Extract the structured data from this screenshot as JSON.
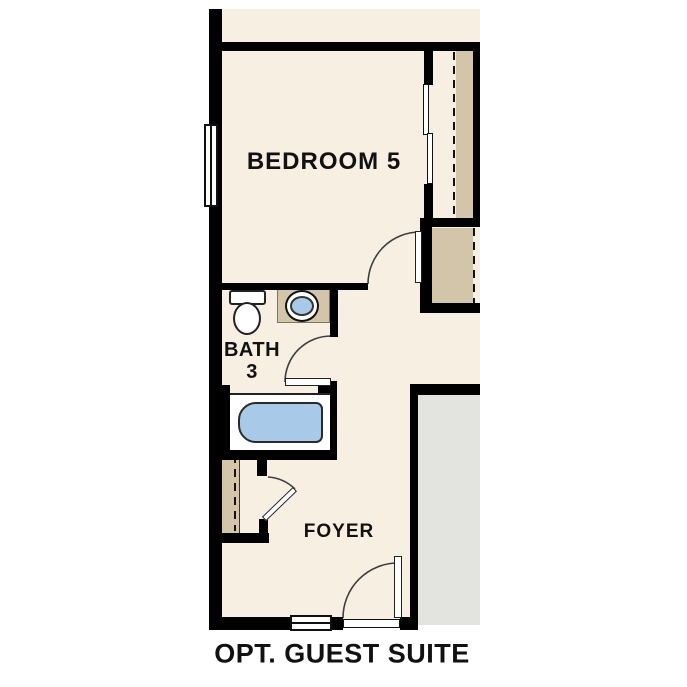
{
  "title": "OPT. GUEST SUITE",
  "rooms": {
    "bedroom": {
      "label": "BEDROOM 5"
    },
    "bath": {
      "label_line1": "BATH",
      "label_line2": "3"
    },
    "foyer": {
      "label": "FOYER"
    }
  },
  "fixtures": [
    "toilet",
    "sink-vanity",
    "bathtub"
  ],
  "doors": [
    "bedroom-door",
    "bath-door",
    "foyer-closet-door",
    "entry-door",
    "closet-sliding-doors"
  ],
  "windows": [
    "bedroom-window",
    "foyer-window"
  ],
  "colors": {
    "floor": "#f8efe3",
    "wall": "#000000",
    "fixture_blue": "#a9c9e8",
    "closet_tan": "#d2c5a9",
    "exterior_gray": "#e3e3e0",
    "swing_line": "#3d3d3d"
  }
}
